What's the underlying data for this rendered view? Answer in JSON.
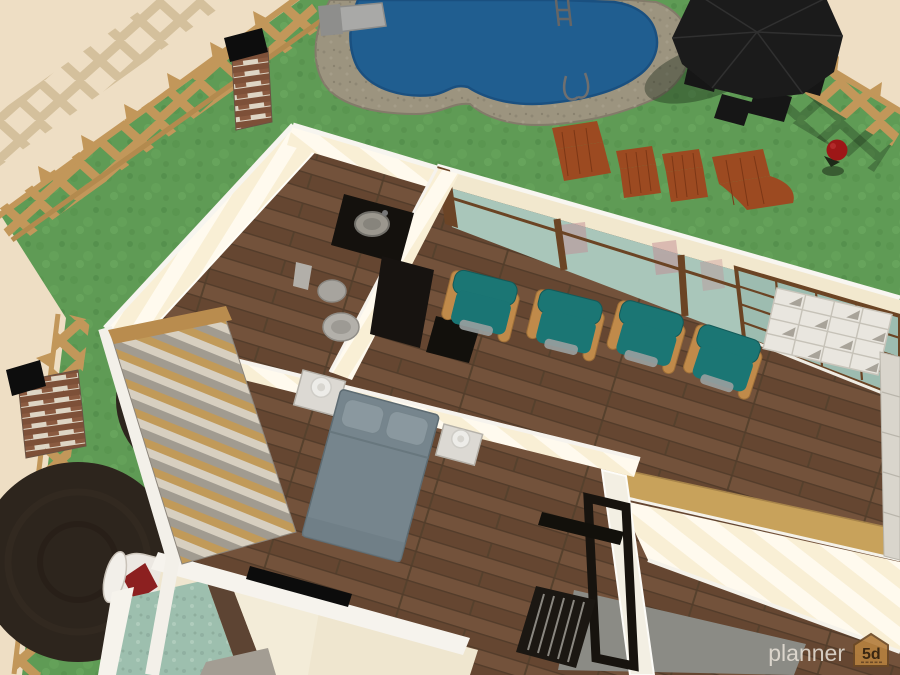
{
  "watermark": {
    "brand": "planner",
    "logo_text": "5d"
  },
  "colors": {
    "beige_ground": "#eedec4",
    "grass": "#5f9b55",
    "fence_tan": "#c2975a",
    "pool_water": "#205e90",
    "pool_deck": "#9c947f",
    "umbrella_dark": "#1b1b1b",
    "lounger_rust": "#9c4a21",
    "flower_red": "#9d1717",
    "tree_dark": "#2d251d",
    "wall_cream": "#f2e8ce",
    "wall_white": "#f6f3ed",
    "wood_floor": "#6a4b37",
    "glass_teal": "#a9c6ba",
    "window_frame_brown": "#6b4424",
    "chair_teal": "#1b7674",
    "chair_wood": "#c08a4a",
    "bed_slate": "#76858d",
    "nightstand_white": "#dcd9d3",
    "shelf_white": "#e9e6df",
    "cap_wood": "#c8a25b",
    "teal_floor": "#9dbfae",
    "gray_slab": "#8b8b85",
    "black_furniture": "#14110d",
    "roll_red": "#8c2020"
  },
  "scene": {
    "type": "3d-floorplan-render",
    "objects": [
      "swimming-pool",
      "pool-deck",
      "diving-board",
      "pool-ladder",
      "garden-fence",
      "brick-pillar",
      "patio-umbrella",
      "patio-dining-set",
      "sun-loungers",
      "red-flower",
      "round-trees",
      "toilet",
      "bathroom-vanity",
      "glass-wall",
      "grid-window",
      "teal-armchairs",
      "cube-shelf",
      "double-bed",
      "nightstands",
      "wardrobe-shutters",
      "tv-panel",
      "drafting-easel",
      "striped-walls",
      "wood-floors"
    ]
  }
}
